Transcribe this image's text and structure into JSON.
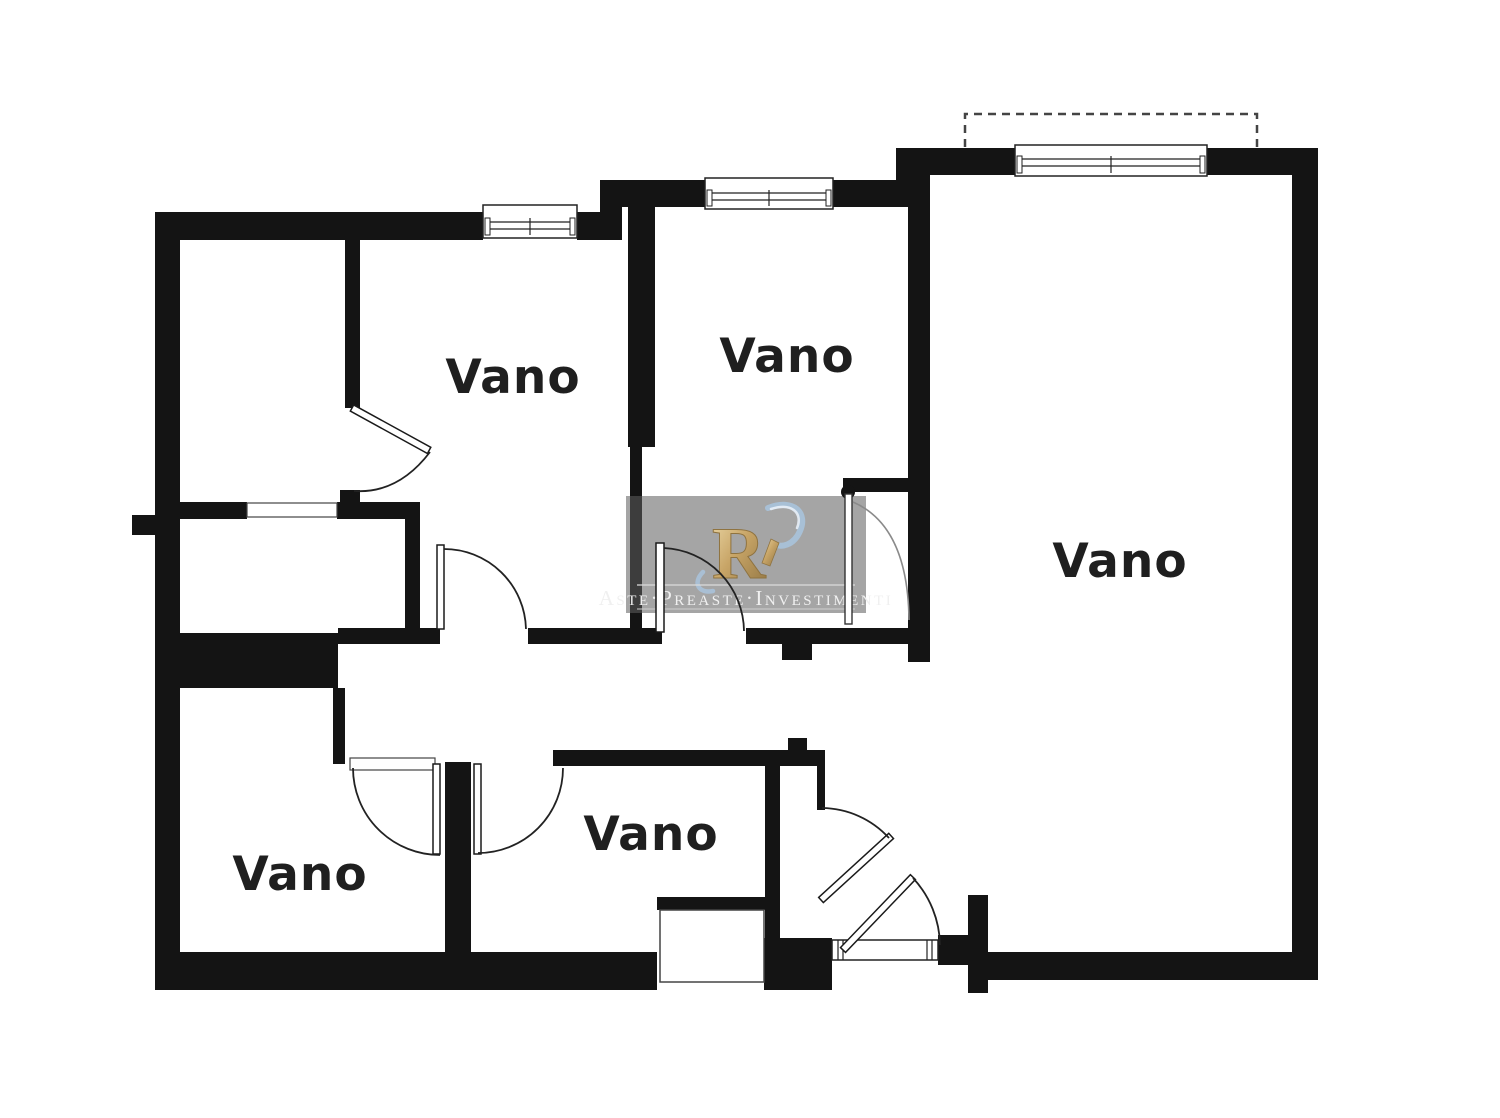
{
  "document": {
    "type": "floor-plan",
    "background": "#ffffff"
  },
  "rooms": [
    {
      "id": "room-top-left",
      "label": "Vano"
    },
    {
      "id": "room-top-middle",
      "label": "Vano"
    },
    {
      "id": "room-right",
      "label": "Vano"
    },
    {
      "id": "room-bottom-left",
      "label": "Vano"
    },
    {
      "id": "room-bottom-middle",
      "label": "Vano"
    }
  ],
  "watermark": {
    "monogram": "R",
    "text": "Aste·Preaste·Investimenti"
  },
  "symbols": {
    "window": "window-symbol",
    "door": "door-swing-symbol",
    "balcony": "balcony-dashed-outline",
    "entrance": "entrance-threshold"
  },
  "colors": {
    "wall": "#141414",
    "line": "#222222",
    "label": "#1f1f1f",
    "wm-bg": "#5f5f5f",
    "gold": "#c8a567",
    "gold-dark": "#97783f",
    "blue": "#a9c3dc",
    "paper": "#ffffff"
  }
}
